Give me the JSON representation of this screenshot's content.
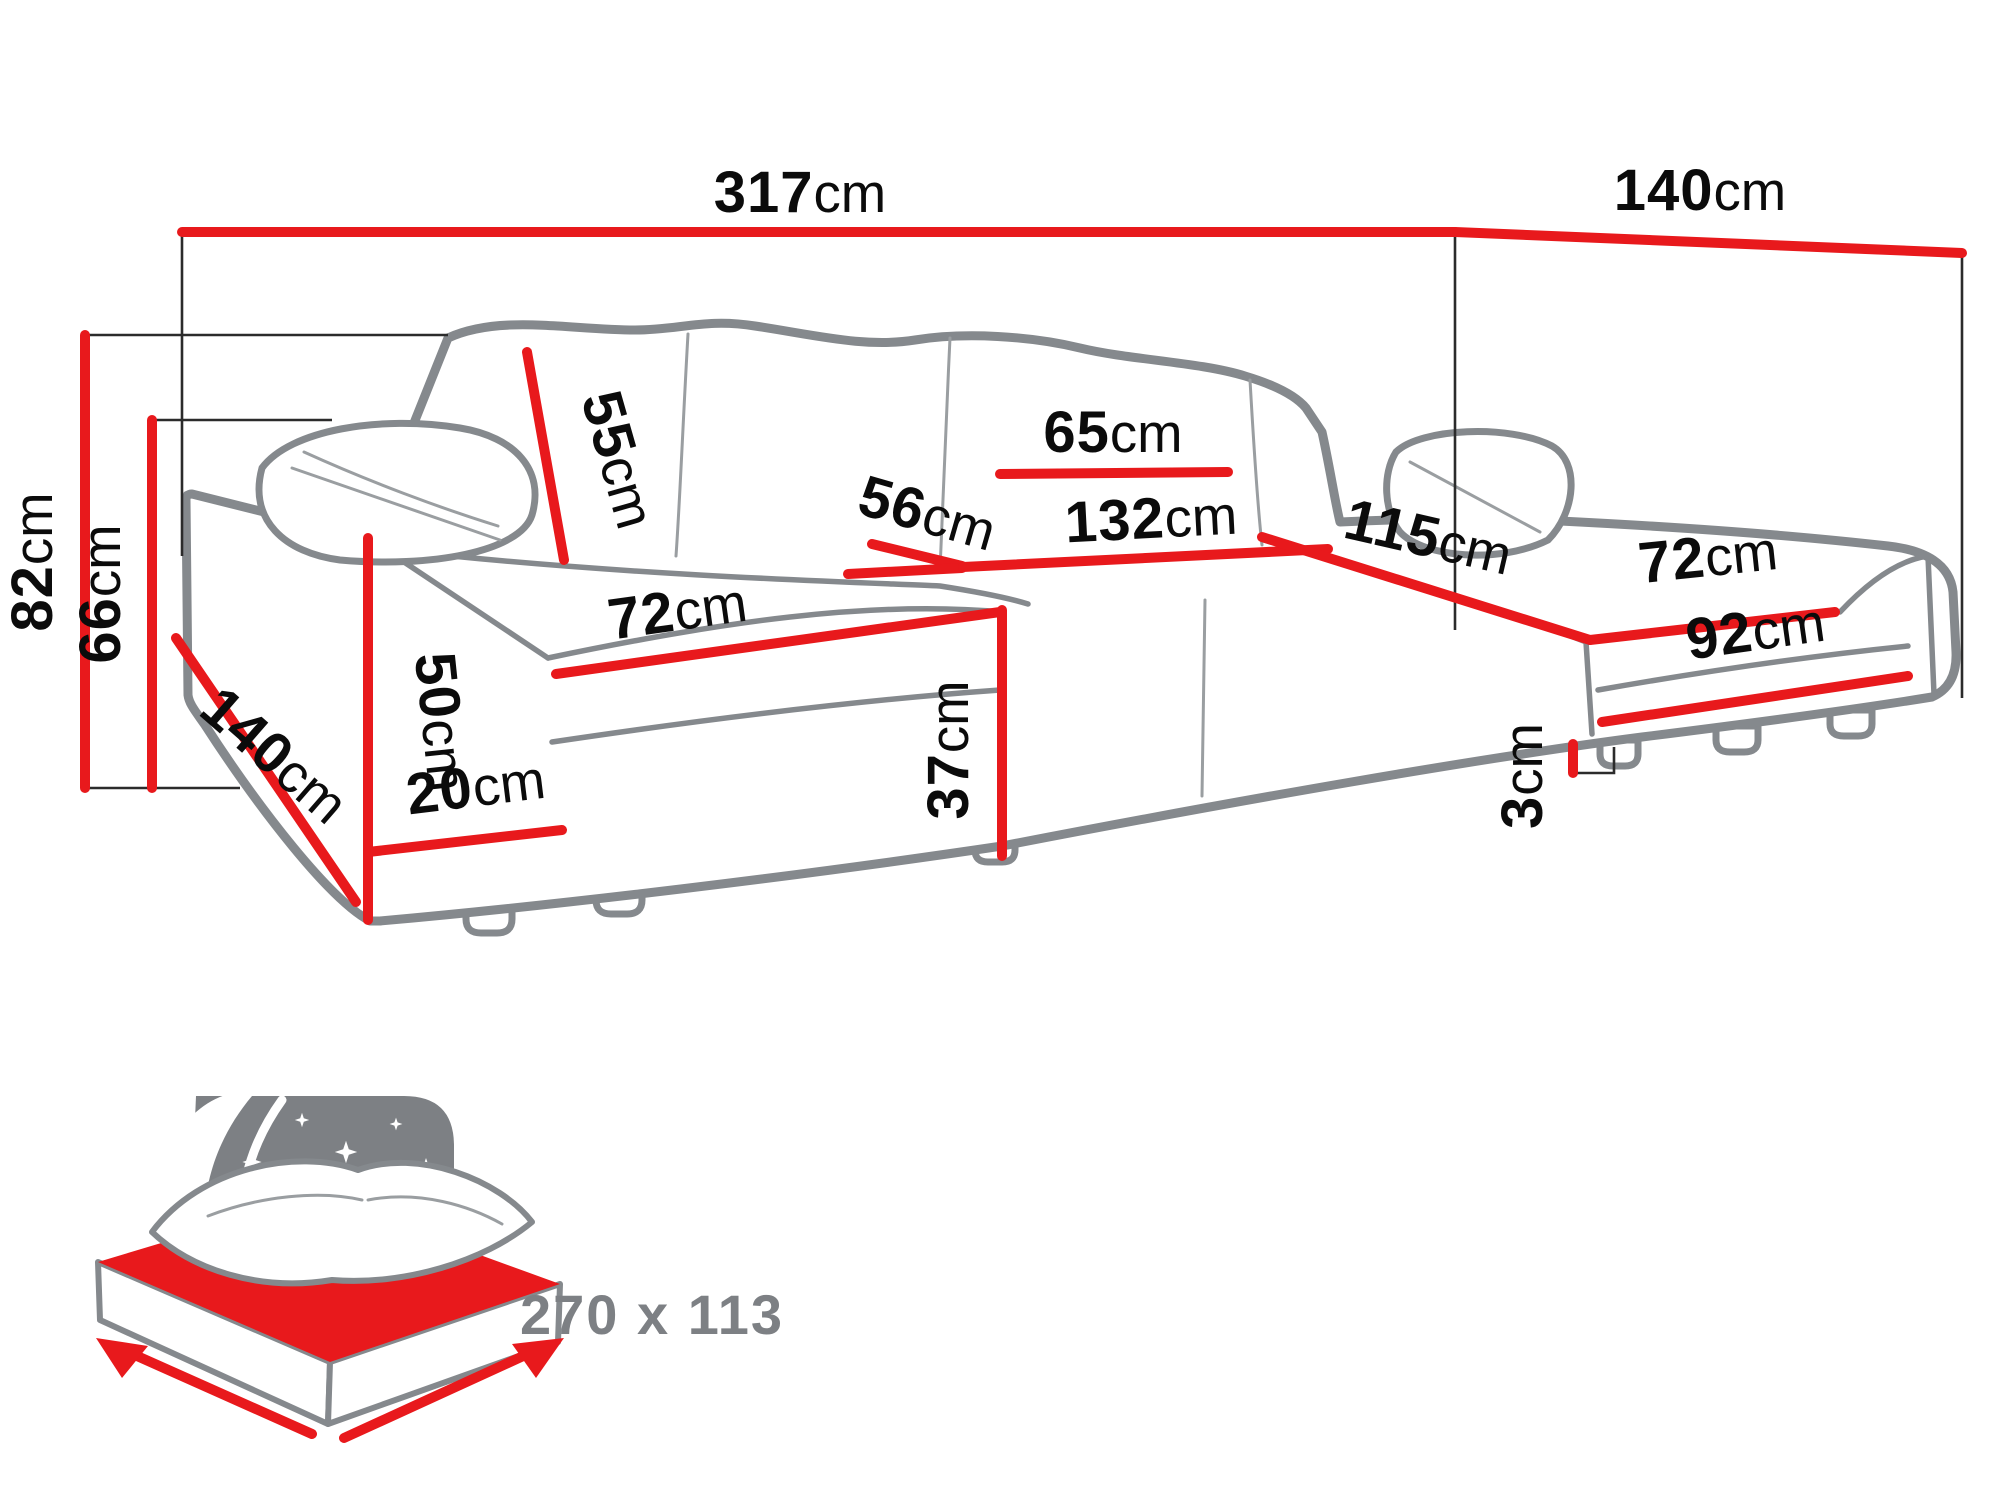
{
  "page": {
    "background": "#ffffff"
  },
  "dimensions": {
    "total_width": {
      "value": "317",
      "unit": "cm"
    },
    "total_depth_right": {
      "value": "140",
      "unit": "cm"
    },
    "total_height": {
      "value": "82",
      "unit": "cm"
    },
    "back_height": {
      "value": "66",
      "unit": "cm"
    },
    "back_cushion_height": {
      "value": "55",
      "unit": "cm"
    },
    "back_cushion_width": {
      "value": "65",
      "unit": "cm"
    },
    "seat_depth": {
      "value": "56",
      "unit": "cm"
    },
    "middle_seat_width": {
      "value": "132",
      "unit": "cm"
    },
    "right_chaise_length": {
      "value": "115",
      "unit": "cm"
    },
    "left_arm_length": {
      "value": "140",
      "unit": "cm"
    },
    "left_seat_width": {
      "value": "72",
      "unit": "cm"
    },
    "right_seat_width": {
      "value": "72",
      "unit": "cm"
    },
    "left_arm_height": {
      "value": "50",
      "unit": "cm"
    },
    "base_height": {
      "value": "20",
      "unit": "cm"
    },
    "seat_height": {
      "value": "37",
      "unit": "cm"
    },
    "right_front_width": {
      "value": "92",
      "unit": "cm"
    },
    "leg_height": {
      "value": "3",
      "unit": "cm"
    }
  },
  "sleeping_function": {
    "icon": "bed-night-icon",
    "dimensions_label": "270 x 113"
  },
  "colors": {
    "dimension_line": "#e8191c",
    "sofa_outline": "#85898d",
    "helper_line": "#2b2b2b",
    "label_text": "#0b0b0b",
    "icon_gray": "#7d8084",
    "background": "#ffffff"
  }
}
